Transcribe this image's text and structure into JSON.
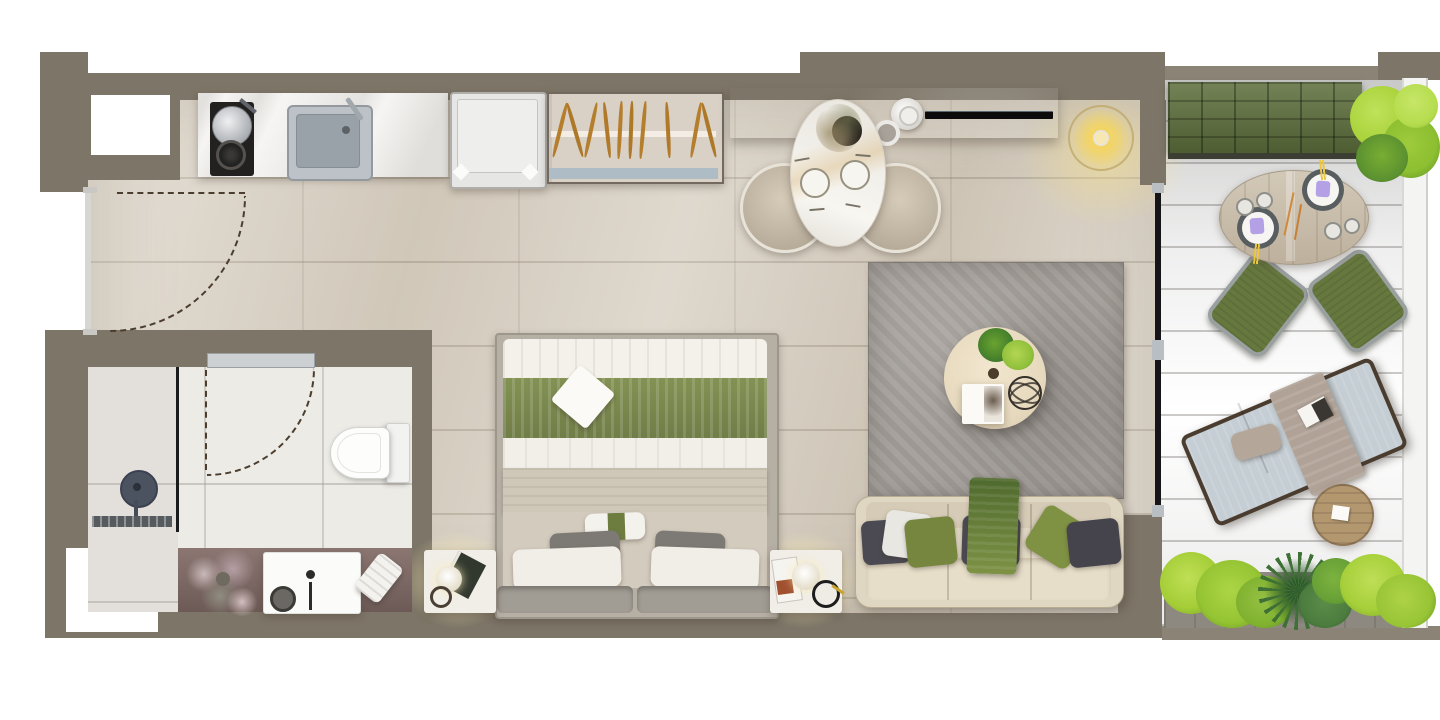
{
  "scene": {
    "type": "apartment-floor-plan-render",
    "view": "top-down",
    "canvas": {
      "width": 1440,
      "height": 720
    }
  },
  "palette": {
    "exterior": "#ffffff",
    "wall": "#7d7567",
    "wall_light": "#8b8376",
    "floor_main": "#d8d0c3",
    "floor_bathroom": "#edebe6",
    "floor_balcony_dark": "#98948b",
    "floor_balcony_light": "#cdc5b5",
    "counter_marble": "#f6f5f3",
    "hob_black": "#222120",
    "sink_steel": "#9aa2a9",
    "fridge_white": "#e6e6e4",
    "wardrobe": "#d9d0c6",
    "hanger_wood": "#b57e2c",
    "console_brown": "#7c6c64",
    "tv_black": "#0b0b0c",
    "pendant_yellow": "#ecd06a",
    "dining_table_white": "#f8f6f1",
    "chair_beige": "#cfc3b1",
    "bed_green": "#8a9a58",
    "duvet_white": "#f3f1ea",
    "blanket_beige": "#cfc7b8",
    "pillow_gray": "#7d7974",
    "rug_gray": "#a39e99",
    "coffee_table_wood": "#ecdfc6",
    "sofa_beige": "#e0d7c3",
    "cushion_graphite": "#4b4a52",
    "cushion_green": "#76863f",
    "throw_green": "#5f7a36",
    "bench_green": "#5d6f3b",
    "balcony_table_wood": "#cbbfab",
    "balcony_chair_green": "#67783f",
    "lounger_cushion": "#c5ced4",
    "lounger_frame": "#4a3d30",
    "plant_bright": "#a4cd37",
    "plant_dark": "#3f7036",
    "napkin_purple": "#b4a0e4",
    "vanity_mauve": "#8b7672",
    "railing_glass": "#f4f4f3",
    "door_swing_dash": "#4c3e2f"
  },
  "rooms": [
    {
      "name": "kitchen-entry",
      "items": [
        "kitchen-counter",
        "cooktop",
        "pot",
        "burner",
        "kitchen-sink",
        "fridge",
        "wardrobe",
        "entry-door-swing"
      ]
    },
    {
      "name": "bathroom",
      "items": [
        "shower-head",
        "shower-partition",
        "drain",
        "toilet",
        "vanity-counter",
        "wash-basin",
        "decor-plant",
        "towel",
        "bathroom-door-swing"
      ]
    },
    {
      "name": "bedroom",
      "items": [
        "double-bed",
        "duvet",
        "green-runner",
        "throw-napkin",
        "pillows",
        "headboard",
        "nightstand-left",
        "nightstand-right",
        "reading-lamps"
      ]
    },
    {
      "name": "dining",
      "items": [
        "oval-dining-table",
        "dining-chair-left",
        "dining-chair-right",
        "flower-vase",
        "place-settings",
        "console-cabinet",
        "tv",
        "decor-vases",
        "pendant-lamp"
      ]
    },
    {
      "name": "living",
      "items": [
        "area-rug",
        "round-coffee-table",
        "coffee-table-plants",
        "books",
        "wire-sphere",
        "sofa",
        "sofa-cushions",
        "green-throw"
      ]
    },
    {
      "name": "balcony",
      "items": [
        "tufted-bench",
        "corner-plant",
        "round-outdoor-table",
        "outdoor-chair-left",
        "outdoor-chair-right",
        "plates-with-napkins",
        "sun-lounger",
        "lounger-pillow",
        "lounger-towel",
        "side-table",
        "planter-box",
        "glass-railing",
        "sliding-door"
      ]
    }
  ]
}
